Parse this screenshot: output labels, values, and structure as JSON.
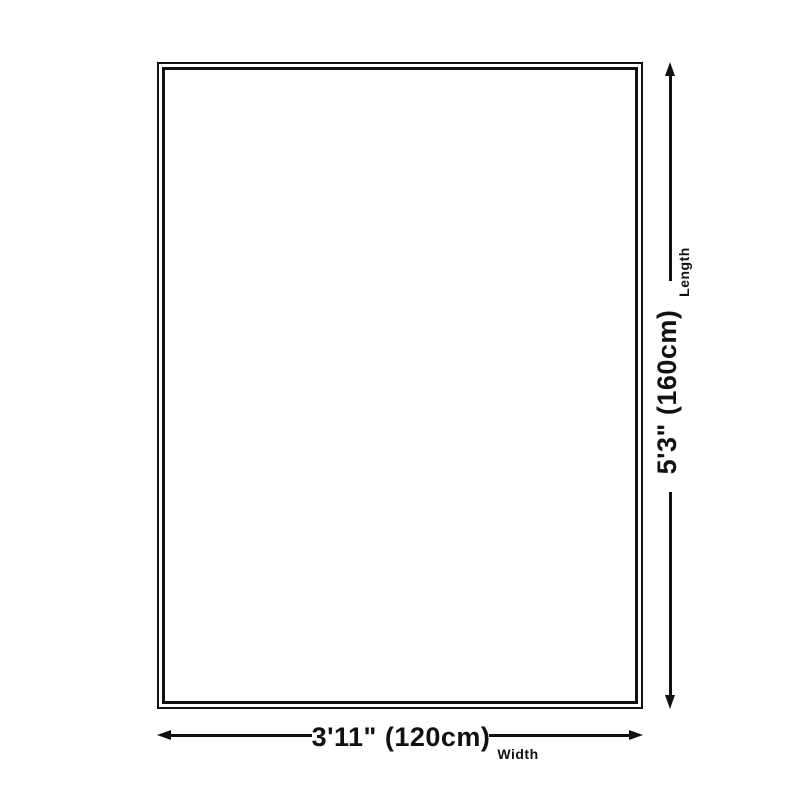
{
  "diagram": {
    "type": "product-size-diagram",
    "background_color": "#ffffff",
    "line_color": "#111111",
    "rug": {
      "border_style": "double-outline rectangle"
    },
    "length": {
      "value": "5'3\" (160cm)",
      "label": "Length"
    },
    "width": {
      "value": "3'11\" (120cm)",
      "label": "Width"
    }
  }
}
